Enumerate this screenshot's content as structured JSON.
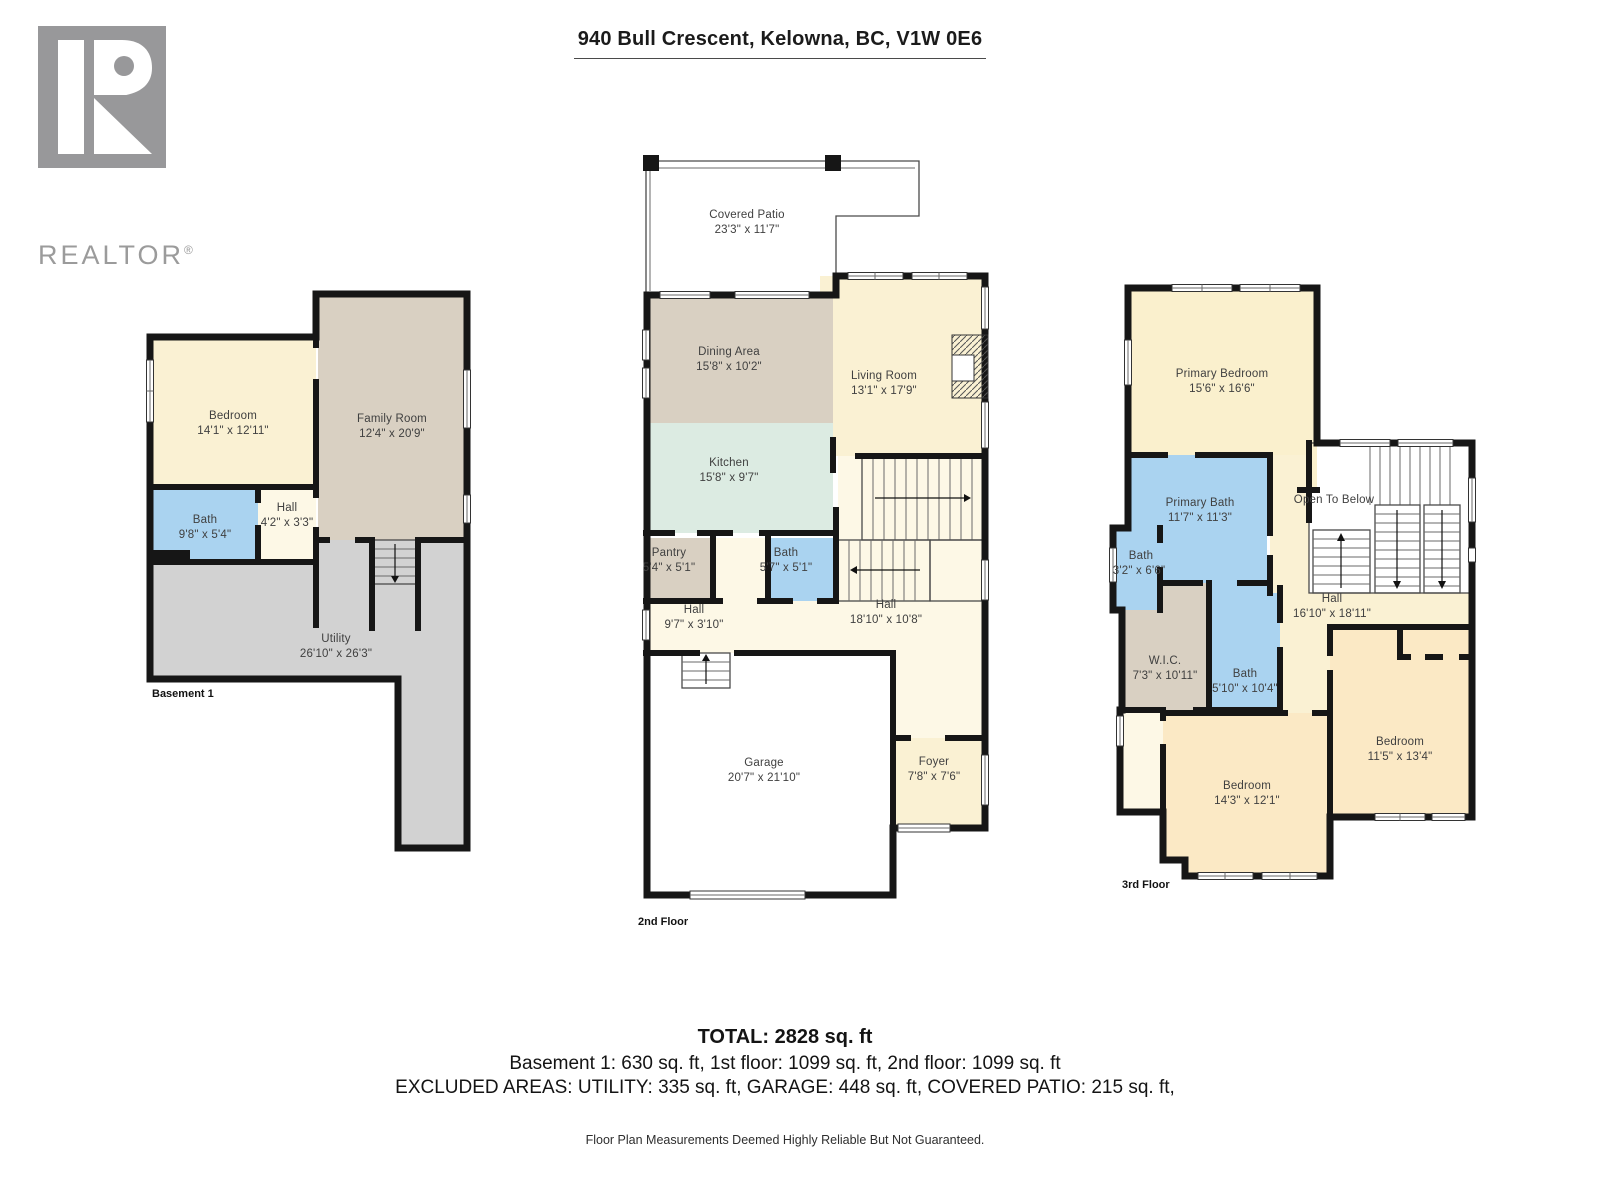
{
  "page": {
    "title": "940 Bull Crescent, Kelowna, BC, V1W 0E6",
    "brand": {
      "logo_text": "REALTOR",
      "registered_mark": "®"
    },
    "summary": {
      "total": "TOTAL: 2828 sq. ft",
      "floors_line": "Basement 1: 630 sq. ft, 1st floor: 1099 sq. ft, 2nd floor: 1099 sq. ft",
      "excluded_line": "EXCLUDED AREAS: UTILITY: 335 sq. ft, GARAGE: 448 sq. ft, COVERED PATIO: 215 sq. ft,",
      "disclaimer": "Floor Plan Measurements Deemed Highly Reliable But Not Guaranteed."
    }
  },
  "colors": {
    "wall": "#161616",
    "room_cream": "#faf1d3",
    "hall_cream": "#fdf8e6",
    "tan": "#d9d0c2",
    "bath_blue": "#aad3f0",
    "kitchen_green": "#dcebe2",
    "utility_grey": "#d2d2d2",
    "bedroom_peach": "#fbe9c5",
    "logo_grey": "#98989a"
  },
  "floors": [
    {
      "label": "Basement 1",
      "rooms": {
        "bedroom": {
          "name": "Bedroom",
          "dims": "14'1\" x 12'11\""
        },
        "family": {
          "name": "Family Room",
          "dims": "12'4\" x 20'9\""
        },
        "bath": {
          "name": "Bath",
          "dims": "9'8\" x 5'4\""
        },
        "hall": {
          "name": "Hall",
          "dims": "4'2\" x 3'3\""
        },
        "utility": {
          "name": "Utility",
          "dims": "26'10\" x 26'3\""
        }
      }
    },
    {
      "label": "2nd Floor",
      "rooms": {
        "patio": {
          "name": "Covered Patio",
          "dims": "23'3\" x 11'7\""
        },
        "dining": {
          "name": "Dining Area",
          "dims": "15'8\" x 10'2\""
        },
        "living": {
          "name": "Living Room",
          "dims": "13'1\" x 17'9\""
        },
        "kitchen": {
          "name": "Kitchen",
          "dims": "15'8\" x 9'7\""
        },
        "pantry": {
          "name": "Pantry",
          "dims": "5'4\" x 5'1\""
        },
        "bath": {
          "name": "Bath",
          "dims": "5'7\" x 5'1\""
        },
        "hall_small": {
          "name": "Hall",
          "dims": "9'7\" x 3'10\""
        },
        "hall_big": {
          "name": "Hall",
          "dims": "18'10\" x 10'8\""
        },
        "garage": {
          "name": "Garage",
          "dims": "20'7\" x 21'10\""
        },
        "foyer": {
          "name": "Foyer",
          "dims": "7'8\" x 7'6\""
        }
      }
    },
    {
      "label": "3rd Floor",
      "rooms": {
        "primary_bedroom": {
          "name": "Primary Bedroom",
          "dims": "15'6\" x 16'6\""
        },
        "primary_bath": {
          "name": "Primary Bath",
          "dims": "11'7\" x 11'3\""
        },
        "bath_small": {
          "name": "Bath",
          "dims": "3'2\" x 6'6\""
        },
        "wic": {
          "name": "W.I.C.",
          "dims": "7'3\" x 10'11\""
        },
        "bath": {
          "name": "Bath",
          "dims": "5'10\" x 10'4\""
        },
        "hall": {
          "name": "Hall",
          "dims": "16'10\" x 18'11\""
        },
        "open_below": {
          "name": "Open To Below"
        },
        "bedroom_left": {
          "name": "Bedroom",
          "dims": "14'3\" x 12'1\""
        },
        "bedroom_right": {
          "name": "Bedroom",
          "dims": "11'5\" x 13'4\""
        }
      }
    }
  ]
}
